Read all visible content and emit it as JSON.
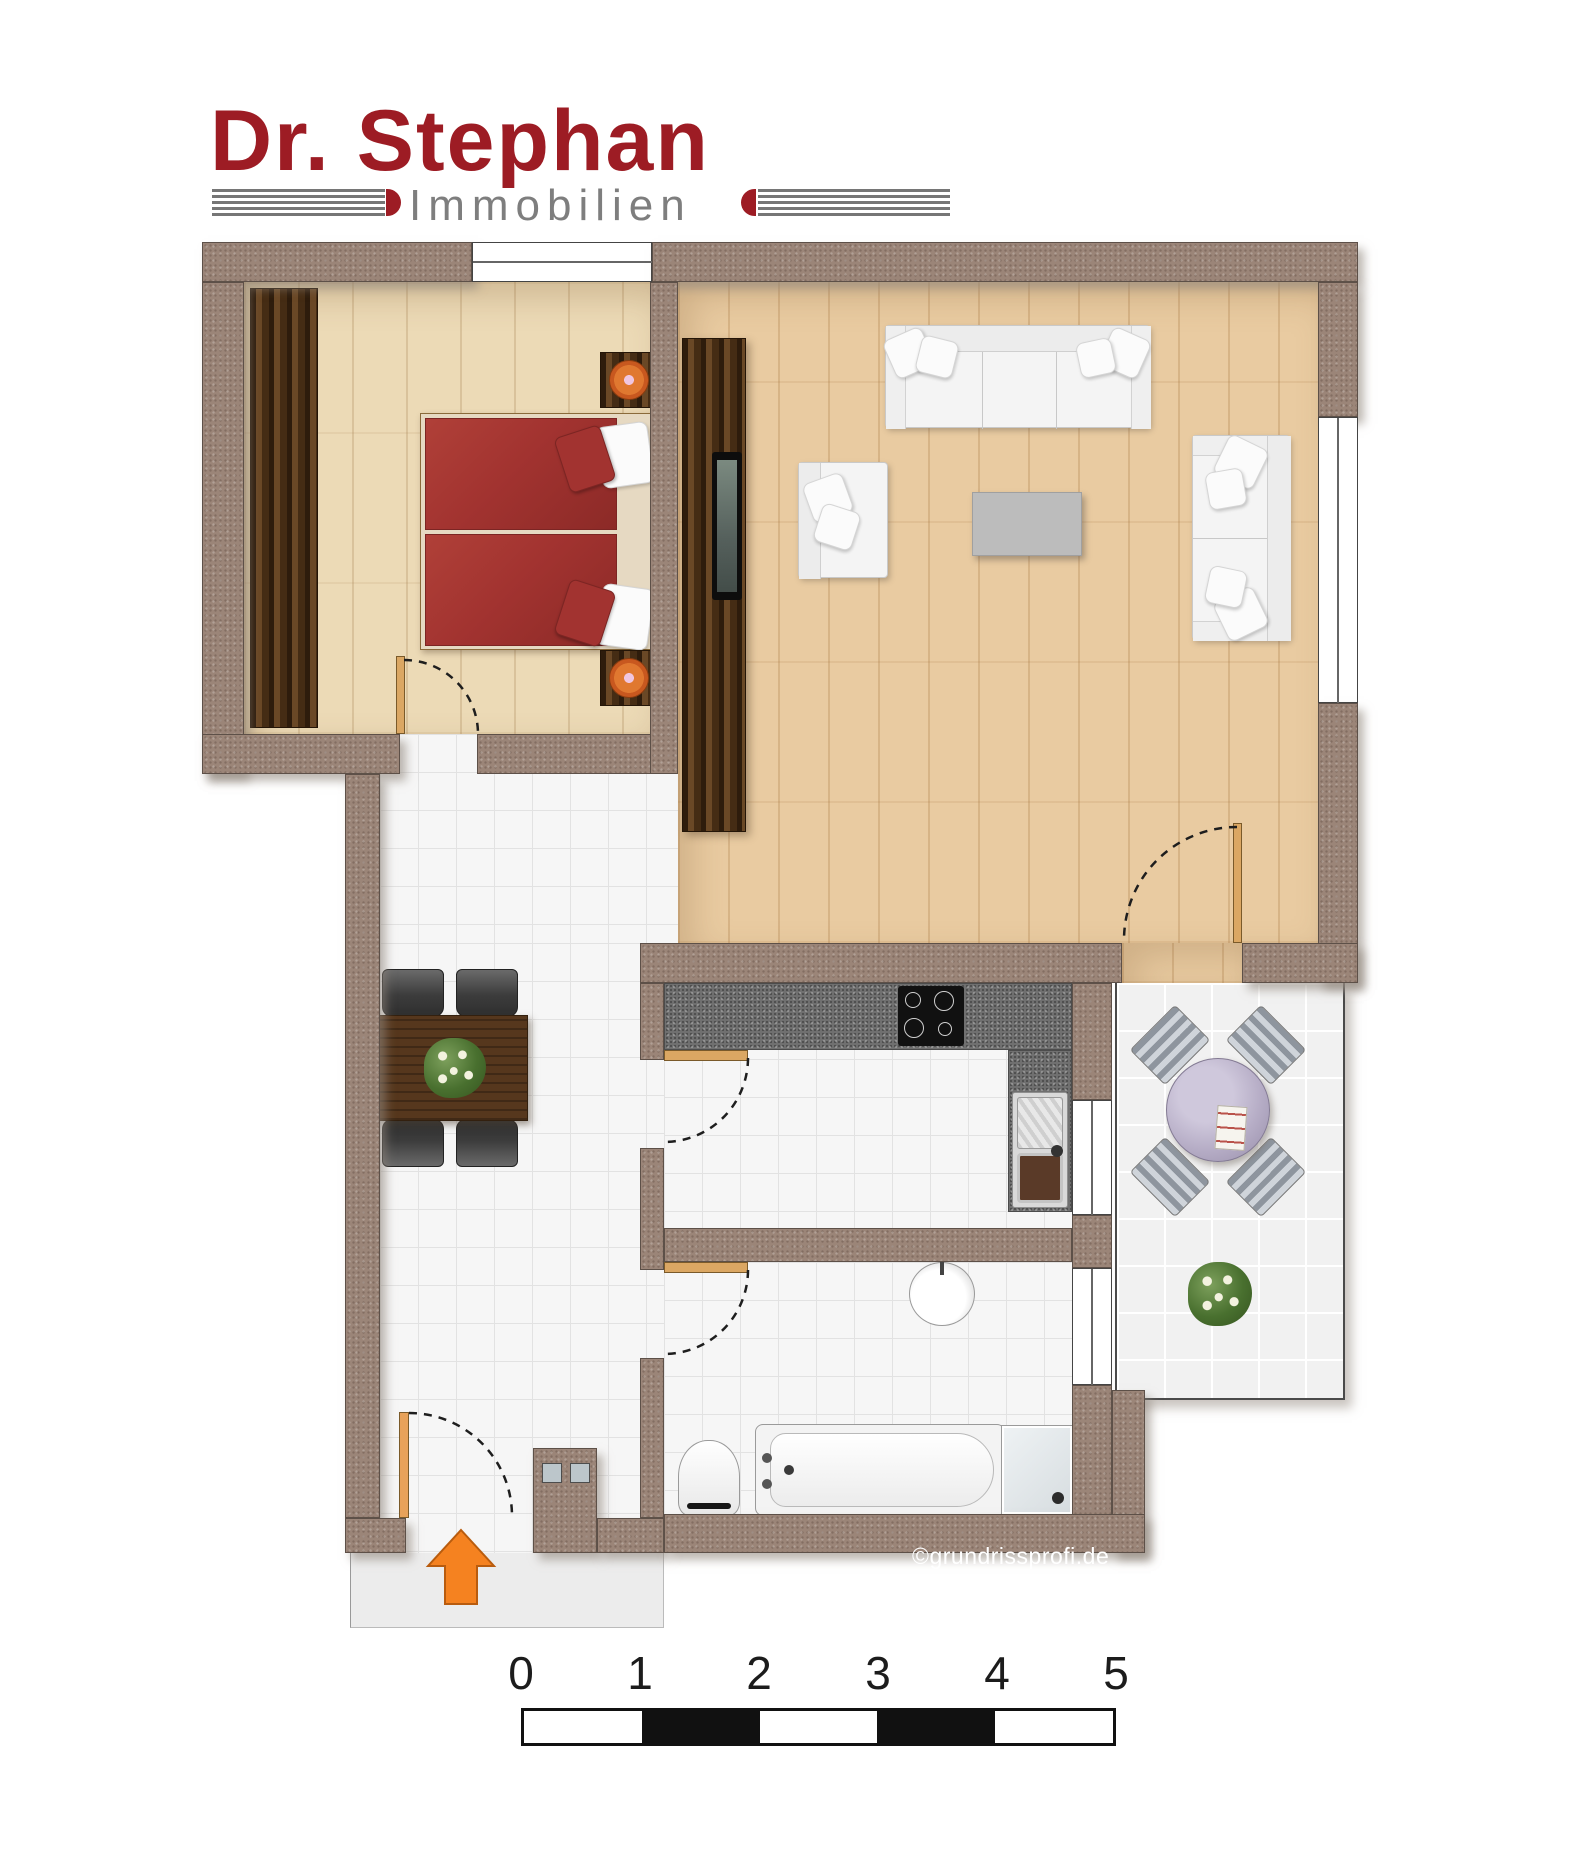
{
  "logo": {
    "title": "Dr. Stephan",
    "subtitle": "Immobilien",
    "title_color": "#9d1c24",
    "subtitle_color": "#7e7e7e"
  },
  "copyright": "©grundrissprofi.de",
  "scale_bar": {
    "labels": [
      "0",
      "1",
      "2",
      "3",
      "4",
      "5"
    ],
    "segment_pattern": [
      "white",
      "black",
      "white",
      "black",
      "white"
    ]
  },
  "colors": {
    "wall": "#9b8578",
    "bedroom_floor": "#ecdab6",
    "living_floor": "#e9cba1",
    "tile_floor": "#f6f6f6",
    "balcony_floor": "#f1f1f1",
    "kitchen_counter": "#707070",
    "bed_red": "#a23330",
    "dark_wood": "#56371d",
    "sofa_white": "#f4f4f4",
    "entrance_arrow_orange": "#f58220",
    "balcony_table_lavender": "#b6adc6"
  },
  "plan": {
    "rooms": [
      {
        "name": "bedroom",
        "furniture": [
          "wardrobe",
          "double-bed",
          "nightstand",
          "nightstand-lamp"
        ]
      },
      {
        "name": "living-room",
        "furniture": [
          "tv-panel",
          "tv",
          "sofa-3-seat",
          "armchair",
          "coffee-table",
          "sofa-2-seat"
        ]
      },
      {
        "name": "hallway",
        "furniture": [
          "dining-table",
          "chairs",
          "flower-centerpiece"
        ]
      },
      {
        "name": "kitchen",
        "furniture": [
          "counter",
          "cooktop",
          "sink"
        ]
      },
      {
        "name": "bathroom",
        "furniture": [
          "washbasin",
          "toilet",
          "bathtub",
          "shower"
        ]
      },
      {
        "name": "balcony",
        "furniture": [
          "round-table",
          "chairs",
          "magazine",
          "plant"
        ]
      },
      {
        "name": "entrance",
        "furniture": [
          "entry-arrow",
          "door-mat",
          "glass-block-wall"
        ]
      }
    ],
    "door_count": 5,
    "window_count": 4
  }
}
